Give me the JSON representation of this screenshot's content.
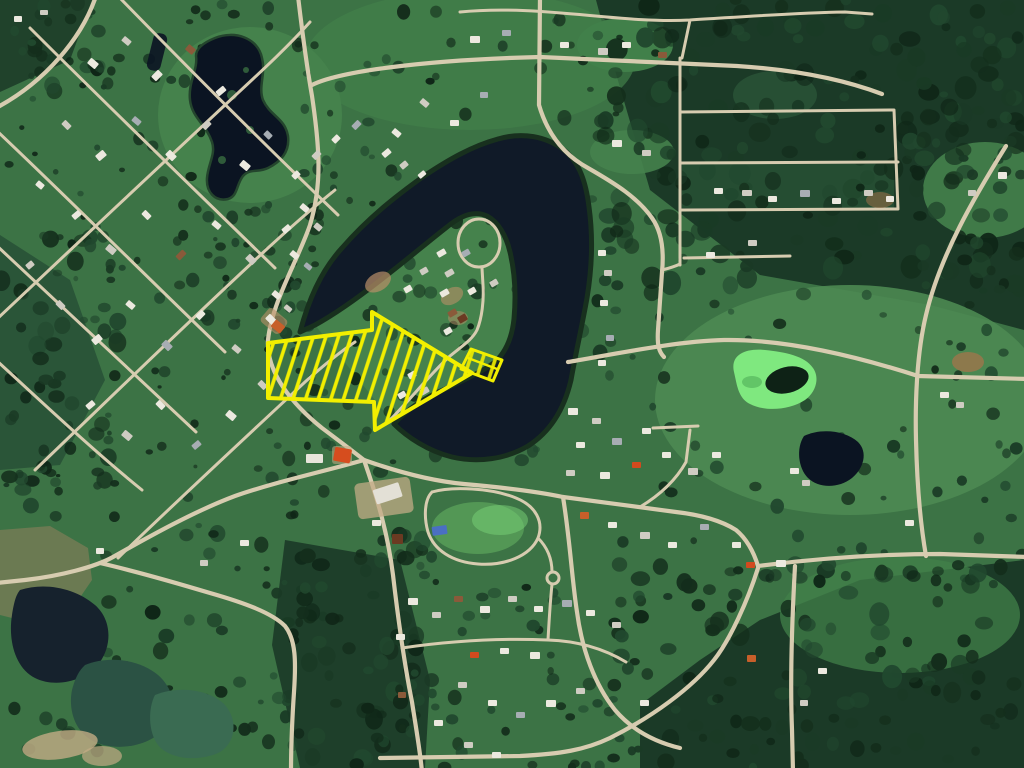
{
  "scene": {
    "type": "satellite-aerial-map",
    "description": "Aerial satellite view of a lakeside village: a dark horseshoe lake wraps a wooded residential peninsula; a large yellow diagonally-hatched arrow annotation points east toward a yellow-outlined highlighted waterfront parcel at the peninsula road bend.",
    "visible_text": "none"
  },
  "palette": {
    "field_base": "#3c7345",
    "field_light": "#4c8a52",
    "field_bright": "#66b463",
    "meadow": "#45824c",
    "village_green": "#41804a",
    "forest_dark": "#1b3a27",
    "forest_darker": "#132b1c",
    "forest_mid": "#2a5538",
    "lake_water": "#101a28",
    "pond_ink": "#0b1422",
    "pond_bright_green": "#7fe87f",
    "pond_dark_center": "#0e2216",
    "pond_teal": "#2b5244",
    "pond_green": "#3a6b52",
    "pond_olive": "#6b7a52",
    "pond_murky": "#16222d",
    "shoreline": "#18301e",
    "road": "#d7ccb0",
    "dirt": "#c2ab85",
    "dirt_warm": "#b98f68",
    "annotation_yellow": "#f2ef00"
  },
  "annotations": {
    "arrow": {
      "name": "hatched-direction-arrow",
      "style": "diagonal-hatch outline arrow",
      "direction": "pointing east-southeast",
      "target": "waterfront parcel on lake peninsula"
    },
    "parcel": {
      "name": "highlighted-waterfront-parcel",
      "shape": "rotated rectangle with lot line",
      "location": "south shore of peninsula at road bend"
    }
  },
  "features": {
    "lake": "dark horseshoe lake around residential peninsula with loop road",
    "ponds": [
      "irregular dark pond northwest in meadow",
      "bright algae-green pond east with dark center",
      "small dark pond southeast of the green pond",
      "cluster of dark and murky ponds in southwest corner"
    ],
    "settlement": "diagonal street-grid village on the west, town center with warehouse and orange building, rural roads east and south",
    "forest": "dense dark conifer forest northeast with rectangular logging blocks, forest belts south and along shores"
  },
  "houses": {
    "colors": [
      "#ece9df",
      "#cfccc2",
      "#a7adb3",
      "#8a5a3a",
      "#c75f2a",
      "#d24a1e",
      "#4a6fc2",
      "#6b3a22"
    ]
  }
}
